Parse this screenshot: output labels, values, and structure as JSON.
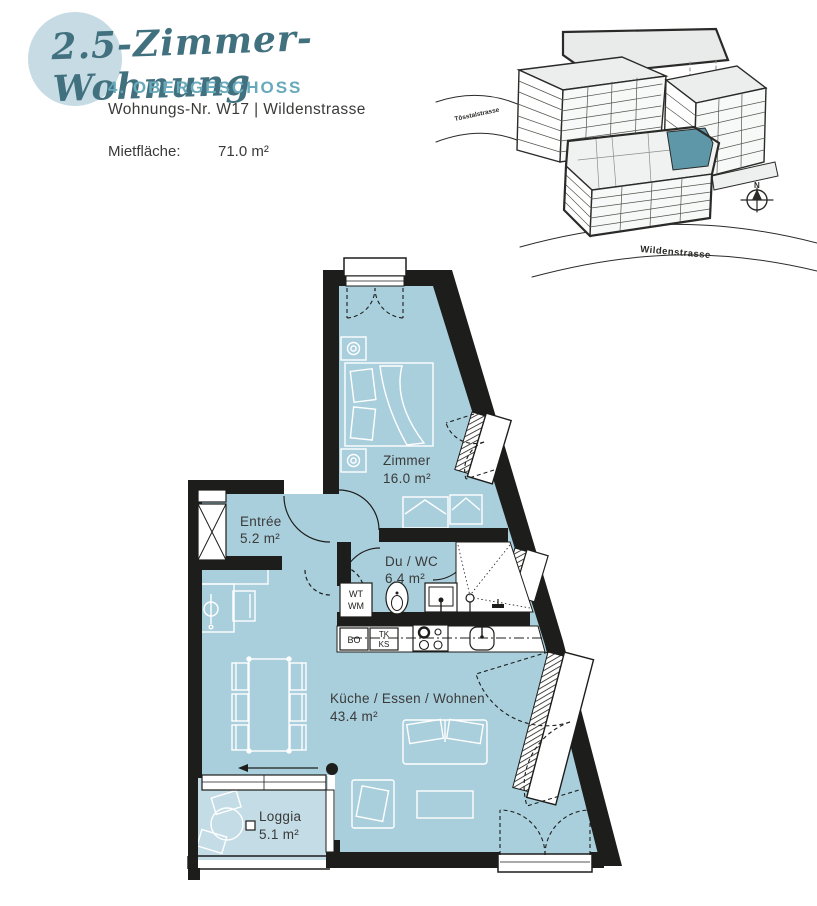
{
  "header": {
    "title": "2.5-Zimmer-Wohnung",
    "floor_label": "4. OBERGESCHOSS",
    "unit_label": "Wohnungs-Nr. W17 | Wildenstrasse",
    "area_label": "Mietfläche:",
    "area_value": "71.0 m²"
  },
  "site": {
    "street_top": "Tösstalstrasse",
    "street_bottom": "Wildenstrasse",
    "north_label": "N"
  },
  "plan": {
    "rooms": [
      {
        "name": "Zimmer",
        "area": "16.0 m²"
      },
      {
        "name": "Entrée",
        "area": "5.2 m²"
      },
      {
        "name": "Du / WC",
        "area": "6.4 m²"
      },
      {
        "name": "Küche / Essen / Wohnen",
        "area": "43.4 m²"
      },
      {
        "name": "Loggia",
        "area": "5.1 m²"
      }
    ],
    "fixtures": {
      "wt": "WT",
      "wm": "WM",
      "bo": "BO",
      "tk": "TK",
      "ks": "KS"
    }
  },
  "colors": {
    "room_fill": "#a9cfdd",
    "loggia_fill": "#c3dce6",
    "wall": "#1d1d1b",
    "accent_teal": "#68a9bb",
    "title_teal": "#41707f",
    "circle": "#c6dbe3",
    "unit_highlight": "#5e98a8"
  }
}
